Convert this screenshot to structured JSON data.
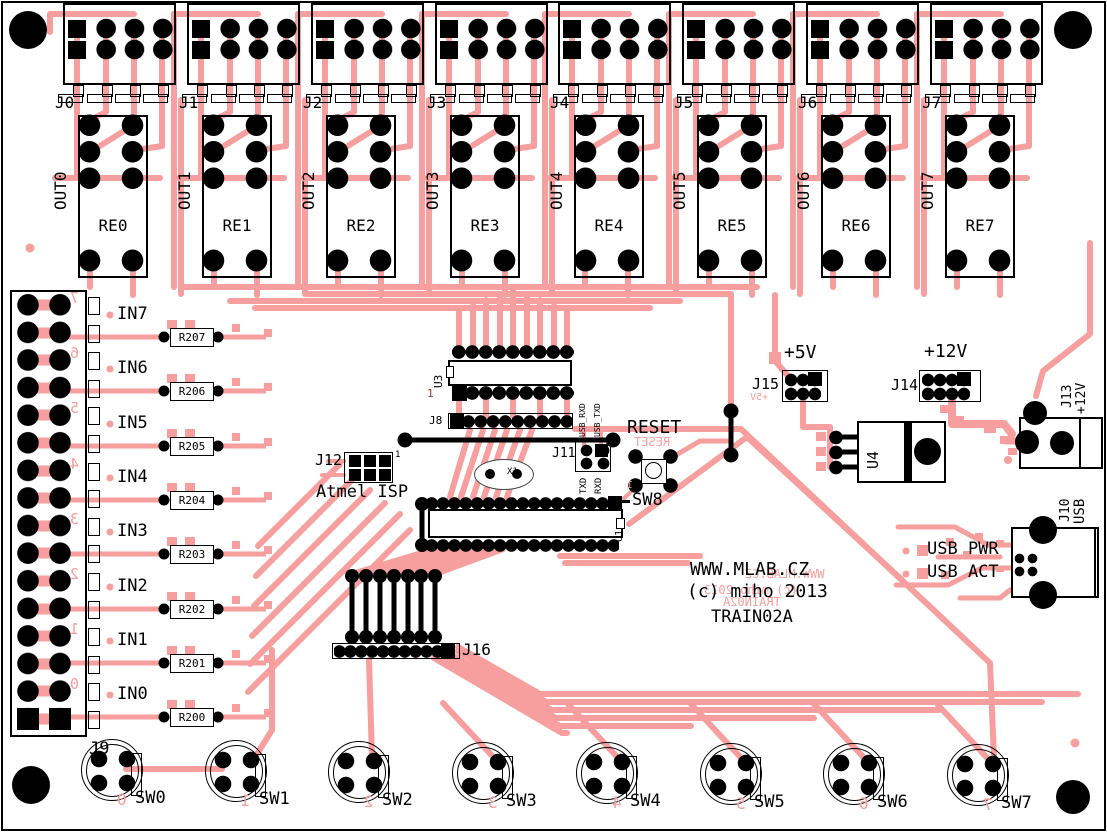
{
  "board": {
    "name": "TRAIN02A",
    "colors": {
      "trace": "#F79E9E",
      "silkscreen": "#000000",
      "background": "#FFFFFF",
      "pad": "#000000"
    }
  },
  "title_block": {
    "website": "WWW.MLAB.CZ",
    "copyright": "(c) miho 2013",
    "board_name": "TRAIN02A"
  },
  "output_headers": [
    {
      "label": "J0"
    },
    {
      "label": "J1"
    },
    {
      "label": "J2"
    },
    {
      "label": "J3"
    },
    {
      "label": "J4"
    },
    {
      "label": "J5"
    },
    {
      "label": "J6"
    },
    {
      "label": "J7"
    }
  ],
  "relays": [
    {
      "label": "RE0",
      "net": "OUT0"
    },
    {
      "label": "RE1",
      "net": "OUT1"
    },
    {
      "label": "RE2",
      "net": "OUT2"
    },
    {
      "label": "RE3",
      "net": "OUT3"
    },
    {
      "label": "RE4",
      "net": "OUT4"
    },
    {
      "label": "RE5",
      "net": "OUT5"
    },
    {
      "label": "RE6",
      "net": "OUT6"
    },
    {
      "label": "RE7",
      "net": "OUT7"
    }
  ],
  "input_header": {
    "label": "J9",
    "pin_numbers_mirrored": [
      "7",
      "6",
      "5",
      "4",
      "3",
      "2",
      "1",
      "0"
    ]
  },
  "inputs": [
    {
      "net": "IN7",
      "resistor": "R207"
    },
    {
      "net": "IN6",
      "resistor": "R206"
    },
    {
      "net": "IN5",
      "resistor": "R205"
    },
    {
      "net": "IN4",
      "resistor": "R204"
    },
    {
      "net": "IN3",
      "resistor": "R203"
    },
    {
      "net": "IN2",
      "resistor": "R202"
    },
    {
      "net": "IN1",
      "resistor": "R201"
    },
    {
      "net": "IN0",
      "resistor": "R200"
    }
  ],
  "ics": {
    "u1": "U1",
    "u3": "U3",
    "u3_pin1": "1"
  },
  "serial_header": {
    "label": "J8"
  },
  "usb_serial_header": {
    "label": "J11",
    "signals_top": [
      "USB_RXD",
      "USB_TXD"
    ],
    "signals_bottom": [
      "TXD",
      "RXD"
    ]
  },
  "isp_header": {
    "label": "J12",
    "caption": "Atmel ISP",
    "pin1": "1"
  },
  "crystal": {
    "label": "X1"
  },
  "reset_button": {
    "net": "RESET",
    "net_mirrored": "RESET",
    "ref": "SW8",
    "pin1_mirrored": "1"
  },
  "expansion_header": {
    "label": "J16"
  },
  "power": {
    "p5v": {
      "net": "+5V",
      "header": "J15",
      "net_mirrored": "+5V"
    },
    "p12v": {
      "net": "+12V",
      "header": "J14"
    },
    "dc_jack": {
      "label": "J13",
      "net": "+12V"
    },
    "regulator": "U4"
  },
  "usb": {
    "label": "J10",
    "net": "USB",
    "led_pwr": "USB PWR",
    "led_act": "USB ACT"
  },
  "switches": [
    {
      "label": "SW0",
      "num_mirrored": "0"
    },
    {
      "label": "SW1",
      "num_mirrored": "1"
    },
    {
      "label": "SW2",
      "num_mirrored": "2"
    },
    {
      "label": "SW3",
      "num_mirrored": "3"
    },
    {
      "label": "SW4",
      "num_mirrored": "4"
    },
    {
      "label": "SW5",
      "num_mirrored": "5"
    },
    {
      "label": "SW6",
      "num_mirrored": "6"
    },
    {
      "label": "SW7",
      "num_mirrored": "7"
    }
  ]
}
